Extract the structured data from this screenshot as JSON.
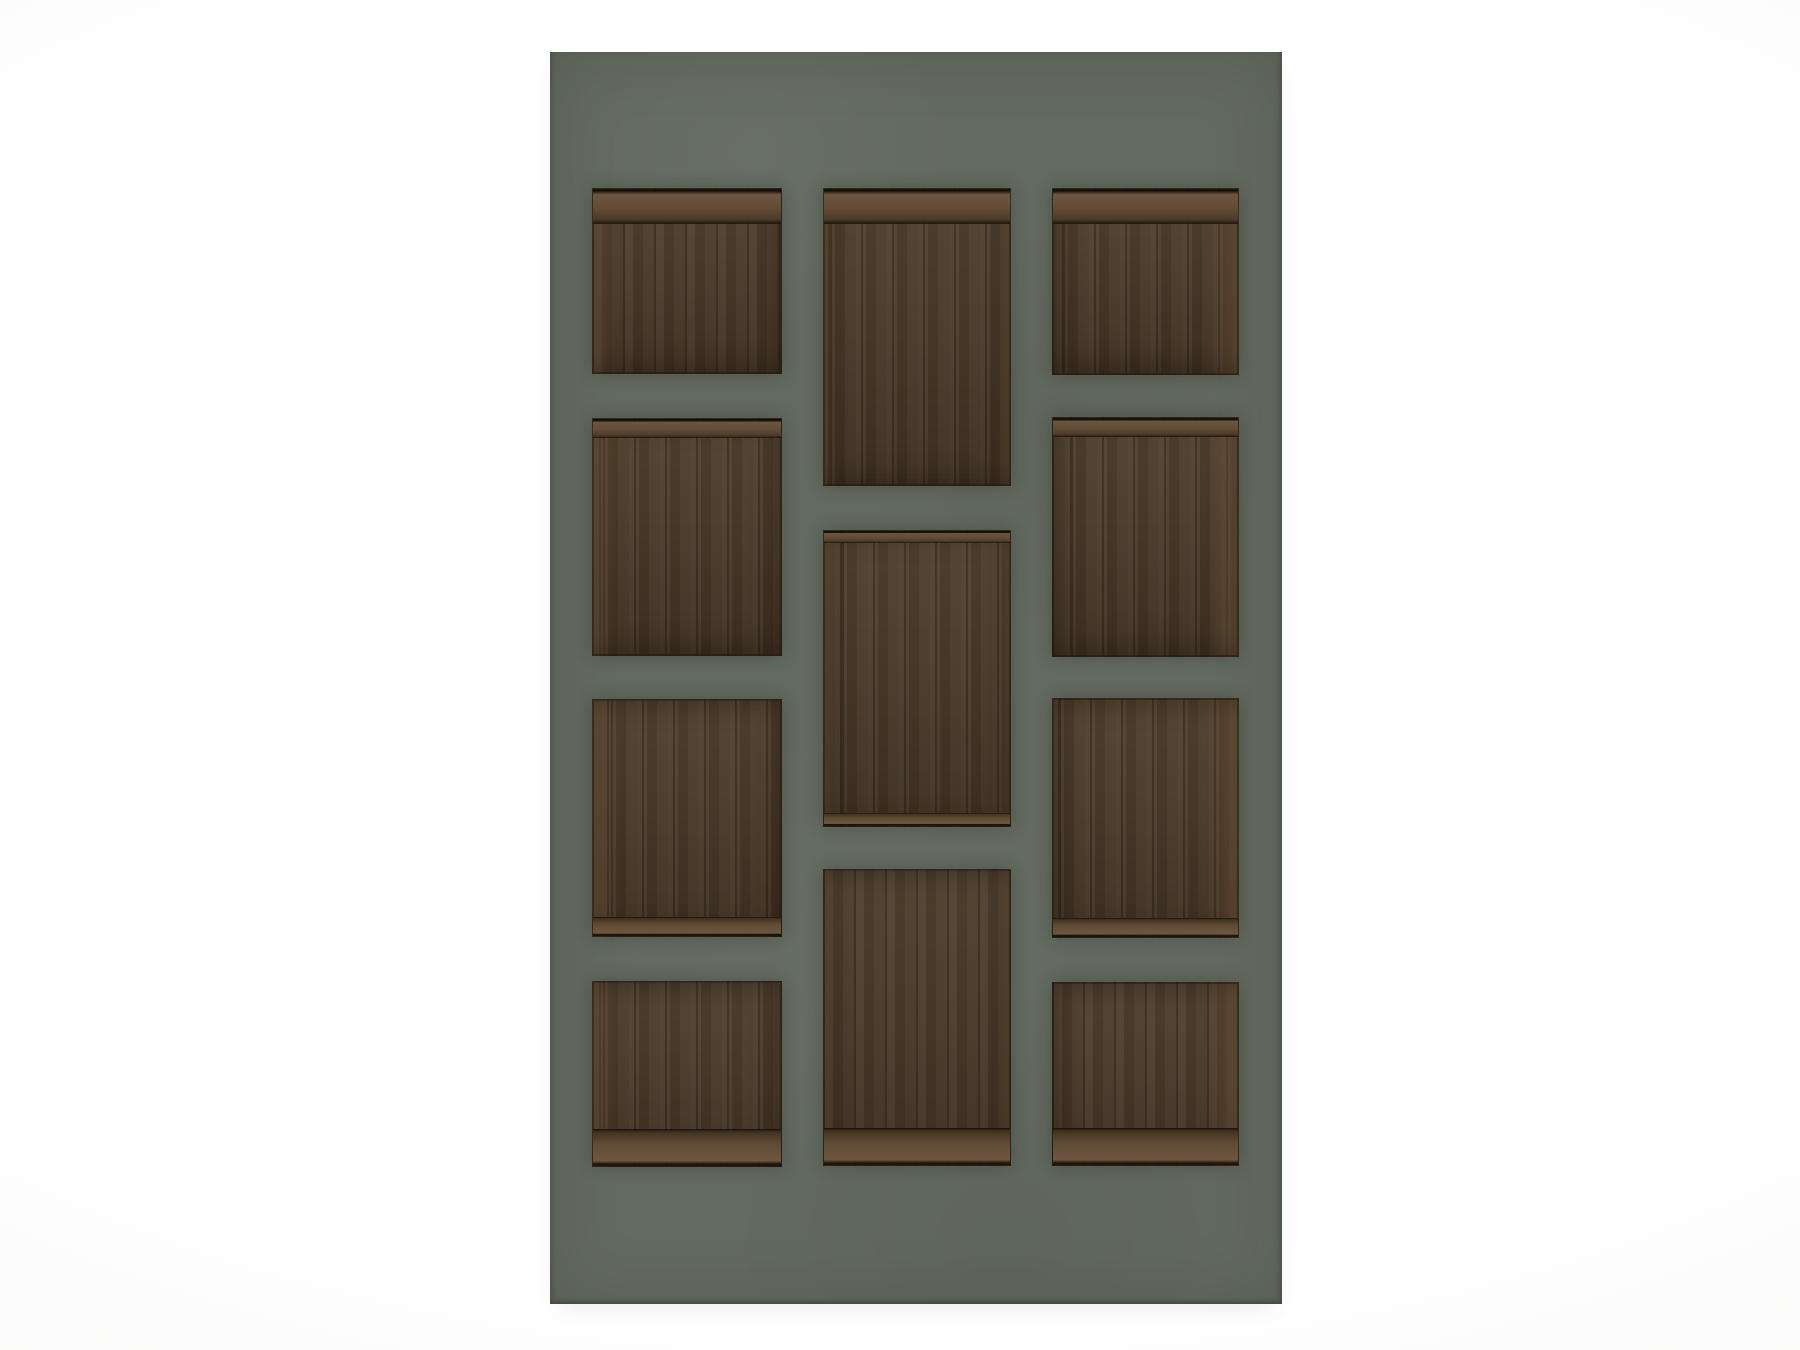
{
  "meta": {
    "description": "3D product render: sage-green wall shelving unit with eleven recessed dark walnut wood niches on a plain white background",
    "text_content": "none"
  },
  "colors": {
    "background": "#fcfcfc",
    "panel": "#636a5f",
    "wood_base": "#49392a",
    "wood_highlight": "#52422f",
    "wood_shadow": "#3e3021",
    "wood_light_edge": "#6e5740",
    "wood_seam": "#2a2014"
  },
  "panel": {
    "x": 550,
    "y": 52,
    "width": 732,
    "height": 1252
  },
  "niches": [
    {
      "name": "niche-left-1",
      "column": "left",
      "row": 1,
      "x": 592,
      "y": 188,
      "w": 190,
      "h": 186,
      "ceiling": "lg",
      "floor": "none"
    },
    {
      "name": "niche-left-2",
      "column": "left",
      "row": 2,
      "x": 592,
      "y": 418,
      "w": 190,
      "h": 238,
      "ceiling": "sm",
      "floor": "none"
    },
    {
      "name": "niche-left-3",
      "column": "left",
      "row": 3,
      "x": 592,
      "y": 699,
      "w": 190,
      "h": 238,
      "ceiling": "none",
      "floor": "sm"
    },
    {
      "name": "niche-left-4",
      "column": "left",
      "row": 4,
      "x": 592,
      "y": 981,
      "w": 190,
      "h": 186,
      "ceiling": "none",
      "floor": "lg"
    },
    {
      "name": "niche-middle-1",
      "column": "middle",
      "row": 1,
      "x": 823,
      "y": 188,
      "w": 188,
      "h": 298,
      "ceiling": "lg",
      "floor": "none"
    },
    {
      "name": "niche-middle-2",
      "column": "middle",
      "row": 2,
      "x": 823,
      "y": 530,
      "w": 188,
      "h": 297,
      "ceiling": "xs",
      "floor": "xs"
    },
    {
      "name": "niche-middle-3",
      "column": "middle",
      "row": 3,
      "x": 823,
      "y": 869,
      "w": 188,
      "h": 297,
      "ceiling": "none",
      "floor": "lg"
    },
    {
      "name": "niche-right-1",
      "column": "right",
      "row": 1,
      "x": 1052,
      "y": 188,
      "w": 187,
      "h": 187,
      "ceiling": "lg",
      "floor": "none"
    },
    {
      "name": "niche-right-2",
      "column": "right",
      "row": 2,
      "x": 1052,
      "y": 417,
      "w": 187,
      "h": 240,
      "ceiling": "sm",
      "floor": "none"
    },
    {
      "name": "niche-right-3",
      "column": "right",
      "row": 3,
      "x": 1052,
      "y": 698,
      "w": 187,
      "h": 240,
      "ceiling": "none",
      "floor": "sm"
    },
    {
      "name": "niche-right-4",
      "column": "right",
      "row": 4,
      "x": 1052,
      "y": 982,
      "w": 187,
      "h": 184,
      "ceiling": "none",
      "floor": "lg"
    }
  ]
}
